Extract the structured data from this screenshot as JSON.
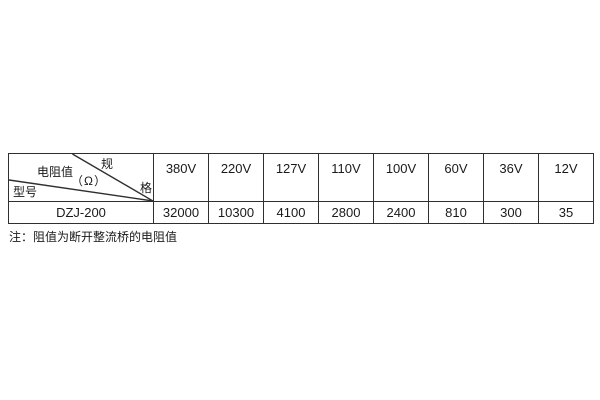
{
  "table": {
    "border_color": "#2f2f2f",
    "corner": {
      "spec_char_top": "规",
      "spec_char_bottom": "格",
      "resistance_label": "电阻值",
      "resistance_unit": "（Ω）",
      "model_label": "型号"
    },
    "voltage_columns": [
      "380V",
      "220V",
      "127V",
      "110V",
      "100V",
      "60V",
      "36V",
      "12V"
    ],
    "rows": [
      {
        "model": "DZJ-200",
        "values": [
          "32000",
          "10300",
          "4100",
          "2800",
          "2400",
          "810",
          "300",
          "35"
        ]
      }
    ]
  },
  "note": "注：阻值为断开整流桥的电阻值"
}
